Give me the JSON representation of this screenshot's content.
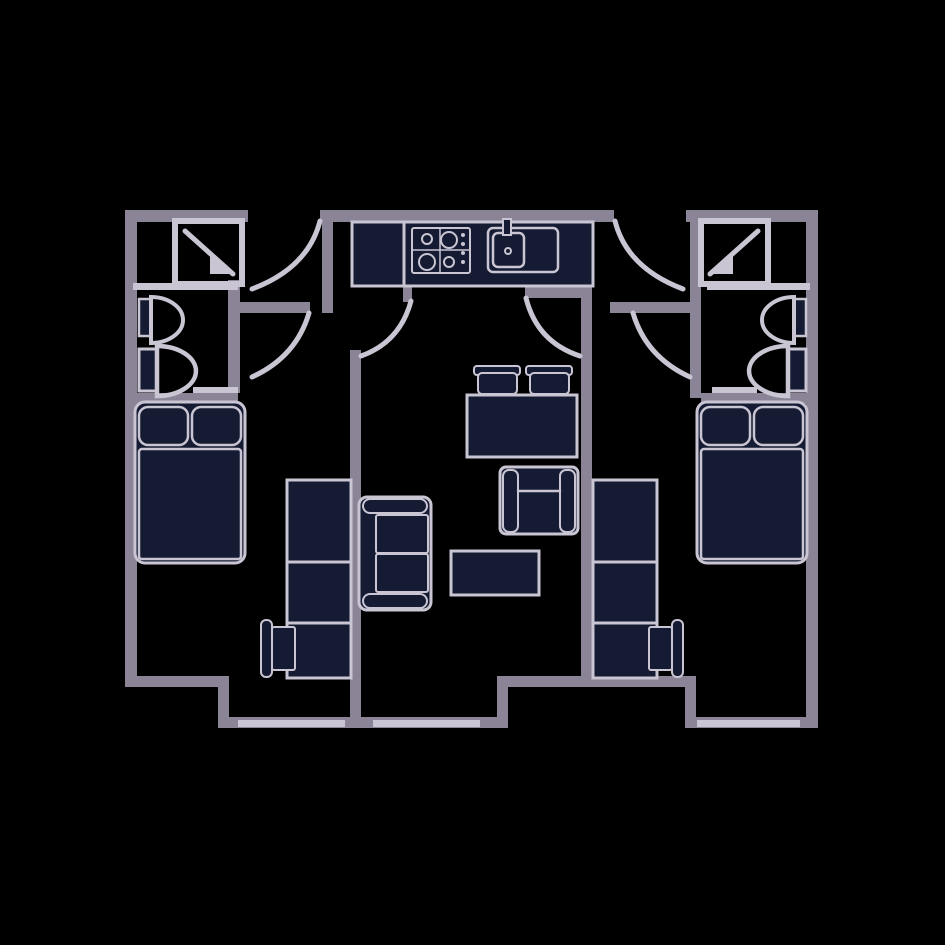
{
  "diagram": {
    "kind": "apartment-floor-plan",
    "description": "Two mirrored studio bedrooms with en-suite shower rooms flanking a shared kitchen and living-dining area",
    "rooms": [
      "bathroom-left",
      "bedroom-left",
      "entry-hall-left",
      "kitchen",
      "living-dining",
      "entry-hall-right",
      "bathroom-right",
      "bedroom-right"
    ]
  },
  "canvas": {
    "width": 945,
    "height": 945,
    "background": "#000000"
  },
  "colors": {
    "wall": "#8A8496",
    "light": "#C9C5D3",
    "dark": "#151B32",
    "none": "none"
  },
  "elements": [
    {
      "name": "wall-top-left",
      "type": "rect",
      "x": 125,
      "y": 210,
      "w": 123,
      "h": 12,
      "fill": "wall"
    },
    {
      "name": "wall-top-middle",
      "type": "rect",
      "x": 320,
      "y": 210,
      "w": 294,
      "h": 12,
      "fill": "wall"
    },
    {
      "name": "wall-top-right",
      "type": "rect",
      "x": 686,
      "y": 210,
      "w": 132,
      "h": 12,
      "fill": "wall"
    },
    {
      "name": "wall-outer-left",
      "type": "rect",
      "x": 125,
      "y": 210,
      "w": 12,
      "h": 477,
      "fill": "wall"
    },
    {
      "name": "wall-outer-right",
      "type": "rect",
      "x": 806,
      "y": 210,
      "w": 12,
      "h": 518,
      "fill": "wall"
    },
    {
      "name": "wall-bottom-left",
      "type": "rect",
      "x": 125,
      "y": 676,
      "w": 104,
      "h": 11,
      "fill": "wall"
    },
    {
      "name": "wall-step-left",
      "type": "rect",
      "x": 218,
      "y": 676,
      "w": 11,
      "h": 52,
      "fill": "wall"
    },
    {
      "name": "wall-bottom-center-left",
      "type": "rect",
      "x": 218,
      "y": 717,
      "w": 290,
      "h": 11,
      "fill": "wall"
    },
    {
      "name": "wall-step-center",
      "type": "rect",
      "x": 497,
      "y": 676,
      "w": 11,
      "h": 52,
      "fill": "wall"
    },
    {
      "name": "wall-bottom-center-right",
      "type": "rect",
      "x": 497,
      "y": 676,
      "w": 199,
      "h": 11,
      "fill": "wall"
    },
    {
      "name": "wall-step-right",
      "type": "rect",
      "x": 685,
      "y": 676,
      "w": 11,
      "h": 52,
      "fill": "wall"
    },
    {
      "name": "wall-bottom-right",
      "type": "rect",
      "x": 685,
      "y": 717,
      "w": 133,
      "h": 11,
      "fill": "wall"
    },
    {
      "name": "wall-bedroom-left-living",
      "type": "rect",
      "x": 350,
      "y": 350,
      "w": 11,
      "h": 378,
      "fill": "wall"
    },
    {
      "name": "wall-living-bedroom-right",
      "type": "rect",
      "x": 581,
      "y": 287,
      "w": 11,
      "h": 400,
      "fill": "wall"
    },
    {
      "name": "wall-hall-left-east",
      "type": "rect",
      "x": 322,
      "y": 210,
      "w": 11,
      "h": 103,
      "fill": "wall"
    },
    {
      "name": "wall-bathroom-right-west",
      "type": "rect",
      "x": 690,
      "y": 210,
      "w": 11,
      "h": 188,
      "fill": "wall"
    },
    {
      "name": "wall-hall-left-south",
      "type": "rect",
      "x": 230,
      "y": 302,
      "w": 80,
      "h": 11,
      "fill": "wall"
    },
    {
      "name": "wall-hall-right-south",
      "type": "rect",
      "x": 610,
      "y": 302,
      "w": 81,
      "h": 11,
      "fill": "wall"
    },
    {
      "name": "wall-bathroom-left-south",
      "type": "rect",
      "x": 125,
      "y": 393,
      "w": 113,
      "h": 11,
      "fill": "wall"
    },
    {
      "name": "wall-bathroom-right-south",
      "type": "rect",
      "x": 701,
      "y": 393,
      "w": 117,
      "h": 11,
      "fill": "wall"
    },
    {
      "name": "wall-wc-left-east",
      "type": "rect",
      "x": 228,
      "y": 280,
      "w": 12,
      "h": 113,
      "fill": "wall"
    },
    {
      "name": "door-leaf-living-left",
      "type": "rect",
      "x": 403,
      "y": 283,
      "w": 9,
      "h": 19,
      "fill": "wall"
    },
    {
      "name": "door-leaf-living-right",
      "type": "rect",
      "x": 525,
      "y": 287,
      "w": 65,
      "h": 11,
      "fill": "wall"
    },
    {
      "name": "window-bottom-left",
      "type": "rect",
      "x": 238,
      "y": 720,
      "w": 107,
      "h": 7,
      "fill": "light"
    },
    {
      "name": "window-bottom-center",
      "type": "rect",
      "x": 373,
      "y": 720,
      "w": 107,
      "h": 7,
      "fill": "light"
    },
    {
      "name": "window-bottom-right",
      "type": "rect",
      "x": 697,
      "y": 720,
      "w": 103,
      "h": 7,
      "fill": "light"
    },
    {
      "name": "threshold-bathroom-left",
      "type": "rect",
      "x": 193,
      "y": 387,
      "w": 45,
      "h": 6,
      "fill": "light"
    },
    {
      "name": "threshold-bathroom-right",
      "type": "rect",
      "x": 712,
      "y": 387,
      "w": 45,
      "h": 6,
      "fill": "light"
    },
    {
      "name": "partition-bathroom-left",
      "type": "rect",
      "x": 133,
      "y": 283,
      "w": 105,
      "h": 7,
      "fill": "light"
    },
    {
      "name": "partition-bathroom-right",
      "type": "rect",
      "x": 707,
      "y": 283,
      "w": 103,
      "h": 7,
      "fill": "light"
    },
    {
      "name": "door-arc-entry-left",
      "type": "path",
      "d": "M 320 221 Q 308 268 252 289",
      "stroke": "light",
      "sw": 5
    },
    {
      "name": "door-arc-bedroom-left",
      "type": "path",
      "d": "M 309 313 Q 296 357 252 377",
      "stroke": "light",
      "sw": 5
    },
    {
      "name": "door-arc-living-left",
      "type": "path",
      "d": "M 411 301 Q 400 342 361 356",
      "stroke": "light",
      "sw": 5
    },
    {
      "name": "door-arc-entry-right",
      "type": "path",
      "d": "M 615 221 Q 627 268 683 289",
      "stroke": "light",
      "sw": 5
    },
    {
      "name": "door-arc-bedroom-right",
      "type": "path",
      "d": "M 633 313 Q 646 357 690 377",
      "stroke": "light",
      "sw": 5
    },
    {
      "name": "door-arc-living-right",
      "type": "path",
      "d": "M 526 298 Q 537 342 580 356",
      "stroke": "light",
      "sw": 5
    },
    {
      "name": "kitchen-counter",
      "type": "rect",
      "x": 352,
      "y": 222,
      "w": 241,
      "h": 64,
      "fill": "dark",
      "stroke": "light",
      "sw": 3
    },
    {
      "name": "kitchen-fridge-divider",
      "type": "line",
      "x1": 404,
      "y1": 224,
      "x2": 404,
      "y2": 284,
      "stroke": "light",
      "sw": 3
    },
    {
      "name": "stove",
      "type": "rect",
      "x": 412,
      "y": 228,
      "w": 58,
      "h": 45,
      "rx": 2,
      "stroke": "light",
      "sw": 2
    },
    {
      "name": "stove-grid-vertical",
      "type": "line",
      "x1": 440,
      "y1": 228,
      "x2": 440,
      "y2": 273,
      "stroke": "light",
      "sw": 1.5
    },
    {
      "name": "stove-grid-horizontal",
      "type": "line",
      "x1": 412,
      "y1": 250,
      "x2": 470,
      "y2": 250,
      "stroke": "light",
      "sw": 1.5
    },
    {
      "name": "stove-burner-small-tl",
      "type": "circle",
      "cx": 427,
      "cy": 239,
      "r": 5,
      "stroke": "light",
      "sw": 2
    },
    {
      "name": "stove-burner-large-tr",
      "type": "circle",
      "cx": 449,
      "cy": 240,
      "r": 8,
      "stroke": "light",
      "sw": 2
    },
    {
      "name": "stove-burner-large-bl",
      "type": "circle",
      "cx": 427,
      "cy": 262,
      "r": 8,
      "stroke": "light",
      "sw": 2
    },
    {
      "name": "stove-burner-small-br",
      "type": "circle",
      "cx": 449,
      "cy": 262,
      "r": 5,
      "stroke": "light",
      "sw": 2
    },
    {
      "name": "stove-knob-1",
      "type": "circle",
      "cx": 463,
      "cy": 235,
      "r": 2,
      "fill": "light"
    },
    {
      "name": "stove-knob-2",
      "type": "circle",
      "cx": 463,
      "cy": 244,
      "r": 2,
      "fill": "light"
    },
    {
      "name": "stove-knob-3",
      "type": "circle",
      "cx": 463,
      "cy": 253,
      "r": 2,
      "fill": "light"
    },
    {
      "name": "stove-knob-4",
      "type": "circle",
      "cx": 463,
      "cy": 262,
      "r": 2,
      "fill": "light"
    },
    {
      "name": "sink-unit",
      "type": "rect",
      "x": 488,
      "y": 228,
      "w": 70,
      "h": 44,
      "rx": 5,
      "stroke": "light",
      "sw": 2.5
    },
    {
      "name": "sink-basin",
      "type": "rect",
      "x": 493,
      "y": 233,
      "w": 31,
      "h": 34,
      "rx": 5,
      "stroke": "light",
      "sw": 2.5
    },
    {
      "name": "sink-drain",
      "type": "circle",
      "cx": 508,
      "cy": 251,
      "r": 3,
      "stroke": "light",
      "sw": 2
    },
    {
      "name": "sink-faucet",
      "type": "rect",
      "x": 503,
      "y": 219,
      "w": 8,
      "h": 16,
      "fill": "dark",
      "stroke": "light",
      "sw": 2
    },
    {
      "name": "dining-chair-1-back",
      "type": "rect",
      "x": 474,
      "y": 366,
      "w": 46,
      "h": 9,
      "rx": 3,
      "fill": "dark",
      "stroke": "light",
      "sw": 2
    },
    {
      "name": "dining-chair-2-back",
      "type": "rect",
      "x": 526,
      "y": 366,
      "w": 46,
      "h": 9,
      "rx": 3,
      "fill": "dark",
      "stroke": "light",
      "sw": 2
    },
    {
      "name": "dining-chair-1-seat",
      "type": "rect",
      "x": 478,
      "y": 373,
      "w": 39,
      "h": 21,
      "rx": 4,
      "fill": "dark",
      "stroke": "light",
      "sw": 2
    },
    {
      "name": "dining-chair-2-seat",
      "type": "rect",
      "x": 530,
      "y": 373,
      "w": 39,
      "h": 21,
      "rx": 4,
      "fill": "dark",
      "stroke": "light",
      "sw": 2
    },
    {
      "name": "dining-table",
      "type": "rect",
      "x": 467,
      "y": 395,
      "w": 110,
      "h": 62,
      "fill": "dark",
      "stroke": "light",
      "sw": 3
    },
    {
      "name": "armchair-body",
      "type": "rect",
      "x": 500,
      "y": 467,
      "w": 78,
      "h": 67,
      "rx": 6,
      "fill": "dark",
      "stroke": "light",
      "sw": 3
    },
    {
      "name": "armchair-arm-left",
      "type": "rect",
      "x": 503,
      "y": 470,
      "w": 15,
      "h": 62,
      "rx": 6,
      "fill": "dark",
      "stroke": "light",
      "sw": 2
    },
    {
      "name": "armchair-arm-right",
      "type": "rect",
      "x": 560,
      "y": 470,
      "w": 15,
      "h": 62,
      "rx": 6,
      "fill": "dark",
      "stroke": "light",
      "sw": 2
    },
    {
      "name": "armchair-back-seam",
      "type": "line",
      "x1": 518,
      "y1": 491,
      "x2": 560,
      "y2": 491,
      "stroke": "light",
      "sw": 2.5
    },
    {
      "name": "sofa-body",
      "type": "rect",
      "x": 359,
      "y": 497,
      "w": 72,
      "h": 113,
      "rx": 8,
      "fill": "dark",
      "stroke": "light",
      "sw": 3
    },
    {
      "name": "sofa-arm-top",
      "type": "rect",
      "x": 363,
      "y": 499,
      "w": 64,
      "h": 14,
      "rx": 7,
      "fill": "dark",
      "stroke": "light",
      "sw": 2
    },
    {
      "name": "sofa-arm-bottom",
      "type": "rect",
      "x": 363,
      "y": 594,
      "w": 64,
      "h": 14,
      "rx": 7,
      "fill": "dark",
      "stroke": "light",
      "sw": 2
    },
    {
      "name": "sofa-cushion-top",
      "type": "rect",
      "x": 376,
      "y": 515,
      "w": 52,
      "h": 38,
      "rx": 2,
      "fill": "dark",
      "stroke": "light",
      "sw": 2
    },
    {
      "name": "sofa-cushion-bottom",
      "type": "rect",
      "x": 376,
      "y": 554,
      "w": 52,
      "h": 38,
      "rx": 2,
      "fill": "dark",
      "stroke": "light",
      "sw": 2
    },
    {
      "name": "coffee-table",
      "type": "rect",
      "x": 451,
      "y": 551,
      "w": 88,
      "h": 44,
      "fill": "dark",
      "stroke": "light",
      "sw": 3
    },
    {
      "name": "bed-left-body",
      "type": "rect",
      "x": 135,
      "y": 402,
      "w": 110,
      "h": 161,
      "rx": 10,
      "fill": "dark",
      "stroke": "light",
      "sw": 3
    },
    {
      "name": "bed-left-pillow-1",
      "type": "rect",
      "x": 139,
      "y": 407,
      "w": 49,
      "h": 38,
      "rx": 9,
      "fill": "dark",
      "stroke": "light",
      "sw": 2.5
    },
    {
      "name": "bed-left-pillow-2",
      "type": "rect",
      "x": 192,
      "y": 407,
      "w": 49,
      "h": 38,
      "rx": 9,
      "fill": "dark",
      "stroke": "light",
      "sw": 2.5
    },
    {
      "name": "bed-left-mattress",
      "type": "rect",
      "x": 139,
      "y": 449,
      "w": 102,
      "h": 110,
      "rx": 3,
      "fill": "dark",
      "stroke": "light",
      "sw": 2.5
    },
    {
      "name": "wardrobe-desk-left",
      "type": "rect",
      "x": 287,
      "y": 480,
      "w": 64,
      "h": 198,
      "fill": "dark",
      "stroke": "light",
      "sw": 3
    },
    {
      "name": "wardrobe-left-shelf-1",
      "type": "line",
      "x1": 287,
      "y1": 562,
      "x2": 351,
      "y2": 562,
      "stroke": "light",
      "sw": 3
    },
    {
      "name": "wardrobe-left-shelf-2",
      "type": "line",
      "x1": 287,
      "y1": 623,
      "x2": 351,
      "y2": 623,
      "stroke": "light",
      "sw": 3
    },
    {
      "name": "desk-chair-left-back",
      "type": "rect",
      "x": 261,
      "y": 620,
      "w": 11,
      "h": 57,
      "rx": 5,
      "fill": "dark",
      "stroke": "light",
      "sw": 2
    },
    {
      "name": "desk-chair-left-seat",
      "type": "rect",
      "x": 272,
      "y": 627,
      "w": 23,
      "h": 43,
      "rx": 2,
      "fill": "dark",
      "stroke": "light",
      "sw": 2
    },
    {
      "name": "bed-right-body",
      "type": "rect",
      "x": 697,
      "y": 402,
      "w": 110,
      "h": 161,
      "rx": 10,
      "fill": "dark",
      "stroke": "light",
      "sw": 3
    },
    {
      "name": "bed-right-pillow-1",
      "type": "rect",
      "x": 701,
      "y": 407,
      "w": 49,
      "h": 38,
      "rx": 9,
      "fill": "dark",
      "stroke": "light",
      "sw": 2.5
    },
    {
      "name": "bed-right-pillow-2",
      "type": "rect",
      "x": 754,
      "y": 407,
      "w": 49,
      "h": 38,
      "rx": 9,
      "fill": "dark",
      "stroke": "light",
      "sw": 2.5
    },
    {
      "name": "bed-right-mattress",
      "type": "rect",
      "x": 701,
      "y": 449,
      "w": 102,
      "h": 110,
      "rx": 3,
      "fill": "dark",
      "stroke": "light",
      "sw": 2.5
    },
    {
      "name": "wardrobe-desk-right",
      "type": "rect",
      "x": 593,
      "y": 480,
      "w": 64,
      "h": 198,
      "fill": "dark",
      "stroke": "light",
      "sw": 3
    },
    {
      "name": "wardrobe-right-shelf-1",
      "type": "line",
      "x1": 593,
      "y1": 562,
      "x2": 657,
      "y2": 562,
      "stroke": "light",
      "sw": 3
    },
    {
      "name": "wardrobe-right-shelf-2",
      "type": "line",
      "x1": 593,
      "y1": 623,
      "x2": 657,
      "y2": 623,
      "stroke": "light",
      "sw": 3
    },
    {
      "name": "desk-chair-right-back",
      "type": "rect",
      "x": 672,
      "y": 620,
      "w": 11,
      "h": 57,
      "rx": 5,
      "fill": "dark",
      "stroke": "light",
      "sw": 2
    },
    {
      "name": "desk-chair-right-seat",
      "type": "rect",
      "x": 649,
      "y": 627,
      "w": 23,
      "h": 43,
      "rx": 2,
      "fill": "dark",
      "stroke": "light",
      "sw": 2
    },
    {
      "name": "shower-left",
      "type": "rect",
      "x": 175,
      "y": 221,
      "w": 67,
      "h": 63,
      "stroke": "light",
      "sw": 6
    },
    {
      "name": "shower-left-glass",
      "type": "line",
      "x1": 185,
      "y1": 231,
      "x2": 233,
      "y2": 274,
      "stroke": "light",
      "sw": 5
    },
    {
      "name": "shower-left-door-wedge",
      "type": "path",
      "d": "M 210 252 L 232 274 L 210 274 Z",
      "fill": "light"
    },
    {
      "name": "basin-left-tank",
      "type": "rect",
      "x": 139,
      "y": 299,
      "w": 12,
      "h": 37,
      "fill": "dark",
      "stroke": "light",
      "sw": 2.5
    },
    {
      "name": "basin-left-bowl",
      "type": "path",
      "d": "M 151 297 A 32 23 0 0 1 151 343 Z",
      "stroke": "light",
      "sw": 4
    },
    {
      "name": "toilet-left-tank",
      "type": "rect",
      "x": 139,
      "y": 349,
      "w": 18,
      "h": 42,
      "fill": "dark",
      "stroke": "light",
      "sw": 3
    },
    {
      "name": "toilet-left-bowl",
      "type": "path",
      "d": "M 157 346 A 39 25 0 0 1 157 396 Z",
      "stroke": "light",
      "sw": 4.5
    },
    {
      "name": "shower-right",
      "type": "rect",
      "x": 701,
      "y": 221,
      "w": 67,
      "h": 63,
      "stroke": "light",
      "sw": 6
    },
    {
      "name": "shower-right-glass",
      "type": "line",
      "x1": 758,
      "y1": 231,
      "x2": 710,
      "y2": 274,
      "stroke": "light",
      "sw": 5
    },
    {
      "name": "shower-right-door-wedge",
      "type": "path",
      "d": "M 733 252 L 711 274 L 733 274 Z",
      "fill": "light"
    },
    {
      "name": "basin-right-tank",
      "type": "rect",
      "x": 794,
      "y": 299,
      "w": 12,
      "h": 37,
      "fill": "dark",
      "stroke": "light",
      "sw": 2.5
    },
    {
      "name": "basin-right-bowl",
      "type": "path",
      "d": "M 794 297 A 32 23 0 0 0 794 343 Z",
      "stroke": "light",
      "sw": 4
    },
    {
      "name": "toilet-right-tank",
      "type": "rect",
      "x": 788,
      "y": 349,
      "w": 18,
      "h": 42,
      "fill": "dark",
      "stroke": "light",
      "sw": 3
    },
    {
      "name": "toilet-right-bowl",
      "type": "path",
      "d": "M 788 346 A 39 25 0 0 0 788 396 Z",
      "stroke": "light",
      "sw": 4.5
    }
  ]
}
